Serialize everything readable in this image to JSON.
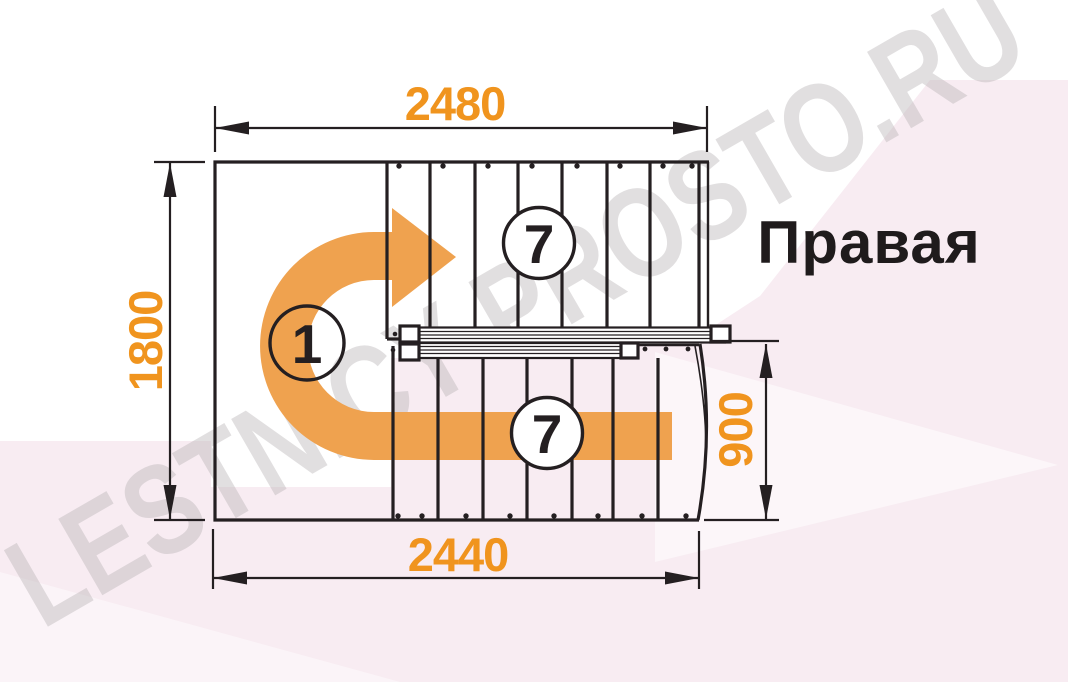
{
  "watermark": {
    "text": "LESTNICY-PROSTO.RU"
  },
  "labels": {
    "orientation": "Правая"
  },
  "dimensions": {
    "top_width_mm": "2480",
    "bottom_width_mm": "2440",
    "left_height_mm": "1800",
    "right_height_mm": "900"
  },
  "markers": {
    "turn_number": "1",
    "upper_flight_step_count": "7",
    "lower_flight_step_count": "7"
  },
  "colors": {
    "dimension_orange": "#f0941e",
    "arrow_orange": "#efa24f",
    "drawing_black": "#241f21",
    "background_pink": "#f8ecf2",
    "watermark_gray": "#b7b2b5"
  }
}
